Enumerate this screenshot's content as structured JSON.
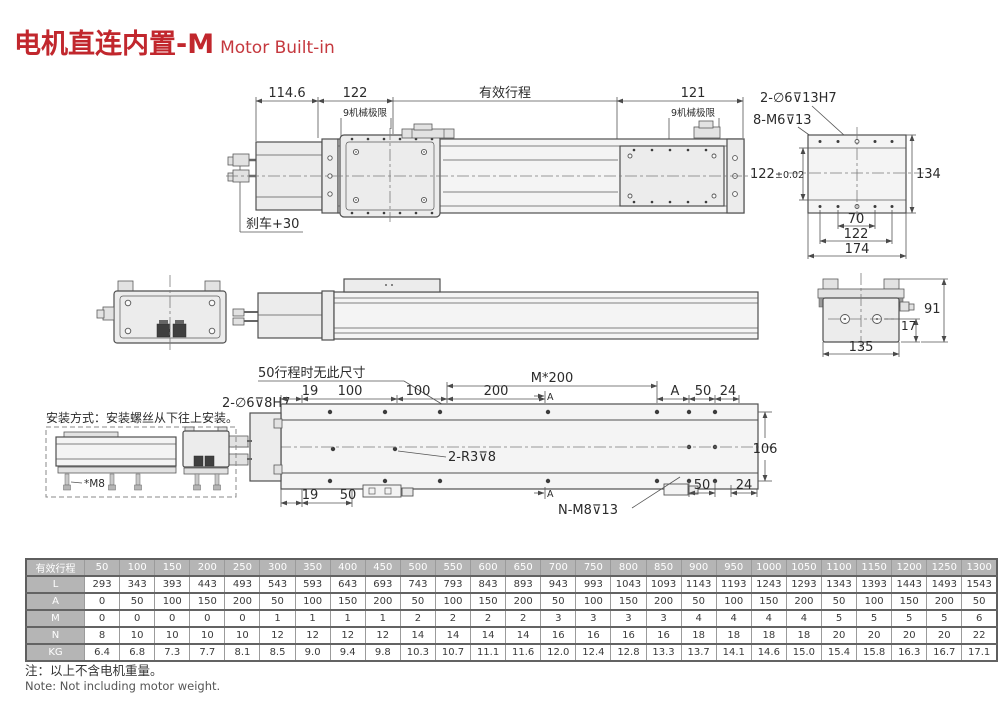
{
  "page": {
    "title_cn": "电机直连内置-M",
    "title_en": "Motor Built-in",
    "note_cn": "注：以上不含电机重量。",
    "note_en": "Note: Not including motor weight."
  },
  "colors": {
    "accent_red": "#c1272d",
    "table_header_bg": "#b5b5b5",
    "line": "#4f4f4f"
  },
  "top_view": {
    "d114_6": "114.6",
    "d122": "122",
    "stroke_label": "有效行程",
    "d121": "121",
    "mech_left": "9机械极限",
    "mech_right": "9机械极限",
    "brake": "刹车+30"
  },
  "slider_detail": {
    "label_holes": "2-∅6⊽13H7",
    "label_threads": "8-M6⊽13",
    "d122_main": "122",
    "d122_tol": "±0.02",
    "d134": "134",
    "d70": "70",
    "d122b": "122",
    "d174": "174"
  },
  "side_view": {
    "d17": "17",
    "d91": "91",
    "d135": "135"
  },
  "bottom_view": {
    "note50": "50行程时无此尺寸",
    "label_holes": "2-∅6⊽8H7",
    "label_pins": "2-R3⊽8",
    "label_n": "N-M8⊽13",
    "d19a": "19",
    "d100a": "100",
    "d100b": "100",
    "d200": "200",
    "m200": "M*200",
    "dA": "A",
    "d50a": "50",
    "d24a": "24",
    "d106": "106",
    "d19b": "19",
    "d50b": "50",
    "d50c": "50",
    "d24b": "24",
    "secA_top": "A",
    "secA_bottom": "A"
  },
  "install": {
    "caption": "安装方式：安装螺丝从下往上安装。",
    "screw_label": "*M8"
  },
  "table": {
    "header_label": "有效行程",
    "header_values": [
      "50",
      "100",
      "150",
      "200",
      "250",
      "300",
      "350",
      "400",
      "450",
      "500",
      "550",
      "600",
      "650",
      "700",
      "750",
      "800",
      "850",
      "900",
      "950",
      "1000",
      "1050",
      "1100",
      "1150",
      "1200",
      "1250",
      "1300"
    ],
    "rows": [
      {
        "label": "L",
        "values": [
          "293",
          "343",
          "393",
          "443",
          "493",
          "543",
          "593",
          "643",
          "693",
          "743",
          "793",
          "843",
          "893",
          "943",
          "993",
          "1043",
          "1093",
          "1143",
          "1193",
          "1243",
          "1293",
          "1343",
          "1393",
          "1443",
          "1493",
          "1543"
        ]
      },
      {
        "label": "A",
        "values": [
          "0",
          "50",
          "100",
          "150",
          "200",
          "50",
          "100",
          "150",
          "200",
          "50",
          "100",
          "150",
          "200",
          "50",
          "100",
          "150",
          "200",
          "50",
          "100",
          "150",
          "200",
          "50",
          "100",
          "150",
          "200",
          "50"
        ]
      },
      {
        "label": "M",
        "values": [
          "0",
          "0",
          "0",
          "0",
          "0",
          "1",
          "1",
          "1",
          "1",
          "2",
          "2",
          "2",
          "2",
          "3",
          "3",
          "3",
          "3",
          "4",
          "4",
          "4",
          "4",
          "5",
          "5",
          "5",
          "5",
          "6"
        ]
      },
      {
        "label": "N",
        "values": [
          "8",
          "10",
          "10",
          "10",
          "10",
          "12",
          "12",
          "12",
          "12",
          "14",
          "14",
          "14",
          "14",
          "16",
          "16",
          "16",
          "16",
          "18",
          "18",
          "18",
          "18",
          "20",
          "20",
          "20",
          "20",
          "22"
        ]
      },
      {
        "label": "KG",
        "values": [
          "6.4",
          "6.8",
          "7.3",
          "7.7",
          "8.1",
          "8.5",
          "9.0",
          "9.4",
          "9.8",
          "10.3",
          "10.7",
          "11.1",
          "11.6",
          "12.0",
          "12.4",
          "12.8",
          "13.3",
          "13.7",
          "14.1",
          "14.6",
          "15.0",
          "15.4",
          "15.8",
          "16.3",
          "16.7",
          "17.1"
        ]
      }
    ]
  }
}
